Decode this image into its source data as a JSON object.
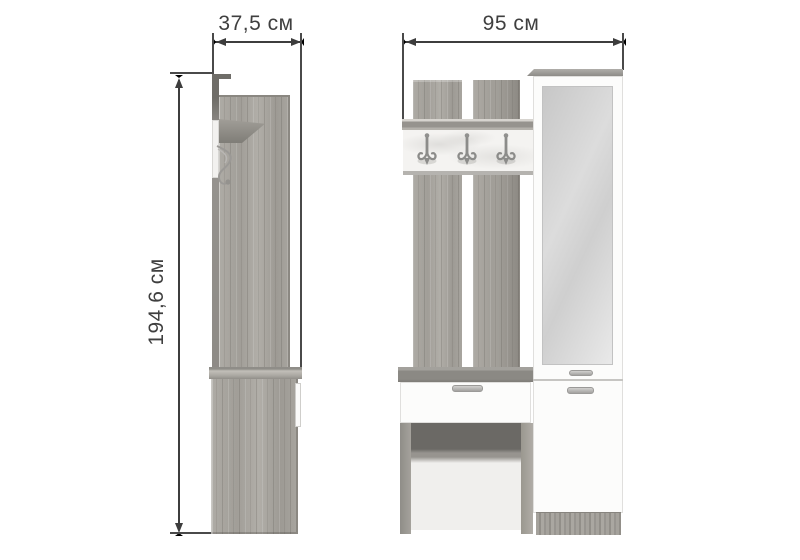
{
  "diagram": {
    "type": "furniture-dimension-drawing",
    "views": {
      "side": {
        "name": "side view",
        "depth_label": "37,5 см"
      },
      "front": {
        "name": "front view",
        "width_label": "95 см"
      },
      "height_label": "194,6 см"
    },
    "features": {
      "hooks_count": 3,
      "hook_rows": 1,
      "drawers_visible": 1,
      "mirror_doors": 1
    },
    "colors": {
      "background": "#ffffff",
      "dimension_line": "#3d3d3d",
      "label_text": "#3f3f3f",
      "wood_oak_gray": "#a8a59f",
      "hook_panel_white": "#f4f3f1",
      "cabinet_white": "#fcfcfb",
      "mirror_gray": "#d6d6d6",
      "bench_gray": "#8b8984",
      "niche_shadow": "#6b6965"
    }
  }
}
